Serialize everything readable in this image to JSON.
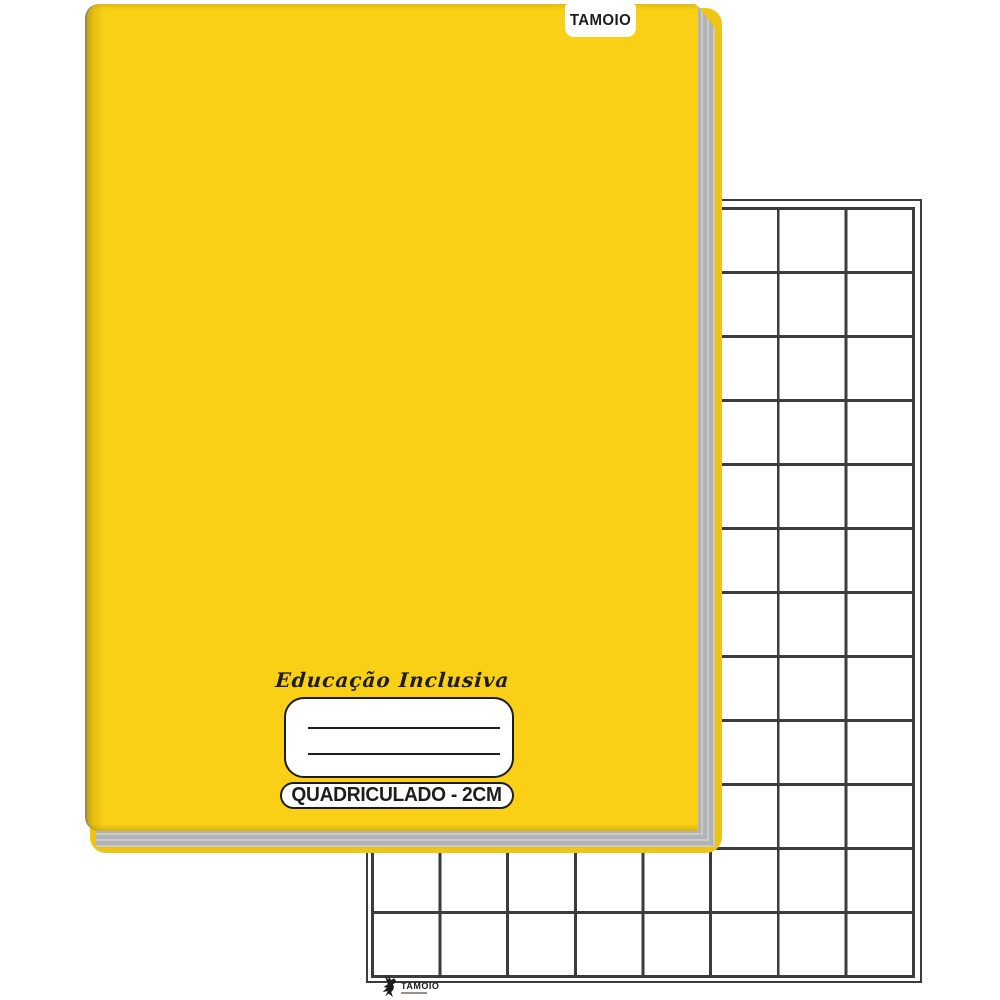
{
  "product": {
    "brand_tab_label": "TAMOIO",
    "collection_script": "Educação Inclusiva",
    "grid_type_label": "QUADRICULADO - 2CM",
    "footer_brand_label": "TAMOIO"
  },
  "name_label_box": {
    "writing_lines": 2
  },
  "grid_sheet": {
    "columns": 8,
    "rows": 12,
    "grid_spacing": "2cm"
  },
  "colors": {
    "cover_yellow": "#F9D015",
    "cover_yellow_dark": "#EFC513",
    "spine_edge": "#8F8A6B",
    "pages_gray": "#B2B3B5",
    "pages_gray_light": "#C9CACC",
    "line_dark": "#3A3C3E",
    "ink_black": "#1D1D1B",
    "paper_white": "#FFFFFF"
  }
}
